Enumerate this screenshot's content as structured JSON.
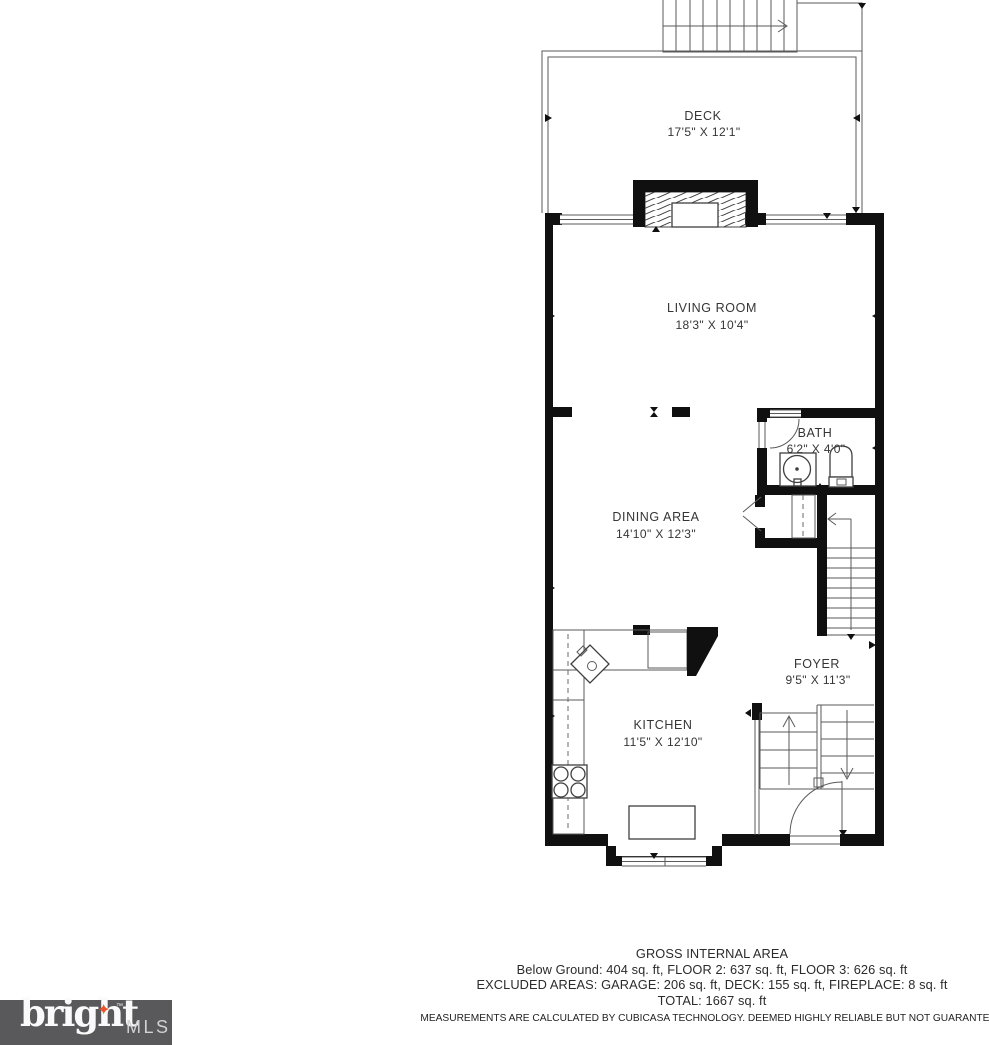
{
  "floorplan": {
    "rooms": {
      "deck": {
        "name": "DECK",
        "dims": "17'5\" X 12'1\""
      },
      "living": {
        "name": "LIVING ROOM",
        "dims": "18'3\" X 10'4\""
      },
      "bath": {
        "name": "BATH",
        "dims": "6'2\" X 4'0\""
      },
      "dining": {
        "name": "DINING AREA",
        "dims": "14'10\" X 12'3\""
      },
      "foyer": {
        "name": "FOYER",
        "dims": "9'5\" X 11'3\""
      },
      "kitchen": {
        "name": "KITCHEN",
        "dims": "11'5\" X 12'10\""
      }
    },
    "colors": {
      "wall": "#101010",
      "thin_line": "#3f3f3f",
      "label_text": "#353535"
    }
  },
  "footer": {
    "title": "GROSS INTERNAL AREA",
    "floors": "Below Ground: 404 sq. ft, FLOOR 2: 637 sq. ft, FLOOR 3: 626 sq. ft",
    "excluded": "EXCLUDED AREAS: GARAGE: 206 sq. ft, DECK: 155 sq. ft, FIREPLACE: 8 sq. ft",
    "total": "TOTAL: 1667 sq. ft",
    "disclaimer": "MEASUREMENTS ARE CALCULATED BY CUBICASA TECHNOLOGY. DEEMED HIGHLY RELIABLE BUT NOT GUARANTEED"
  },
  "logo": {
    "brand": "bright",
    "mls": "MLS",
    "tm": "™",
    "star": "✦",
    "bg_color": "#59595b",
    "star_color": "#e8532c"
  }
}
